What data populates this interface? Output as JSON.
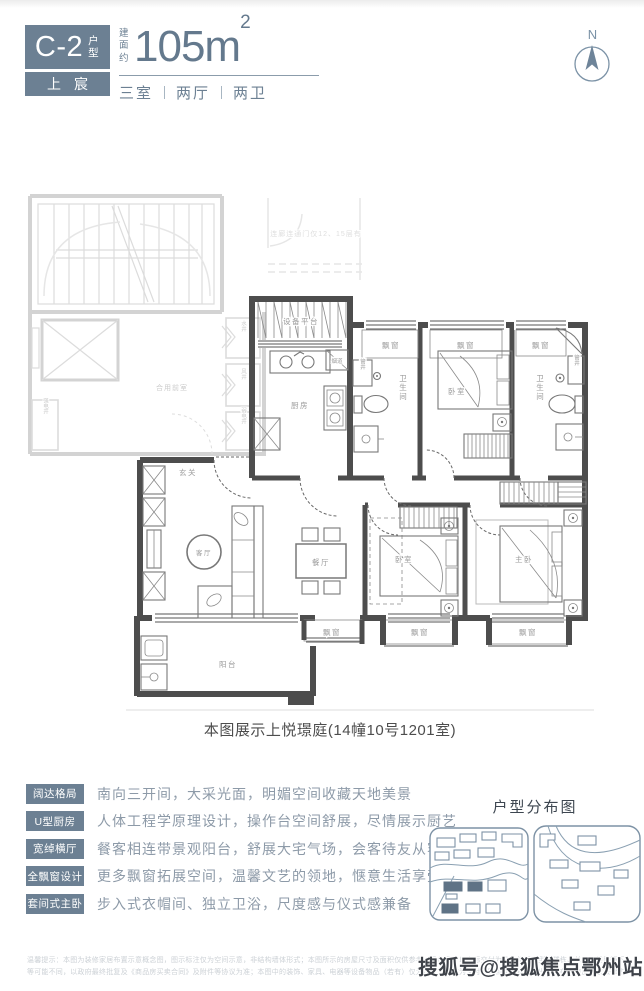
{
  "header": {
    "unit_code": "C-2",
    "unit_type": "户型",
    "brand": "上宸",
    "area_prefix": "建面约",
    "area_value": "105m",
    "area_sup": "2",
    "layout": [
      "三室",
      "两厅",
      "两卫"
    ],
    "north": "N"
  },
  "plan": {
    "common": {
      "bridge_note": "连廊连通门仅12、15层有",
      "shared_lobby": "合用前室",
      "water_shaft": "水井",
      "air_shaft": "风井",
      "weak_elec_shaft": "弱电井",
      "strong_elec_shaft": "强电井"
    },
    "rooms": {
      "equipment_platform": "设备平台",
      "kitchen": "厨房",
      "flue": "烟道",
      "pipe_shaft": "管井",
      "bathroom": "卫生间",
      "bay_window": "飘窗",
      "bedroom": "卧室",
      "master_bedroom": "主卧",
      "entry": "玄关",
      "living_room": "客厅",
      "dining_room": "餐厅",
      "balcony": "阳台"
    }
  },
  "caption": "本图展示上悦璟庭(14幢10号1201室)",
  "features": [
    {
      "tag": "阔达格局",
      "desc": "南向三开间，大采光面，明媚空间收藏天地美景"
    },
    {
      "tag": "U型厨房",
      "desc": "人体工程学原理设计，操作台空间舒展，尽情展示厨艺"
    },
    {
      "tag": "宽绰横厅",
      "desc": "餐客相连带景观阳台，舒展大宅气场，会客待友从容不迫"
    },
    {
      "tag": "全飘窗设计",
      "desc": "更多飘窗拓展空间，温馨文艺的领地，惬意生活享受"
    },
    {
      "tag": "套间式主卧",
      "desc": "步入式衣帽间、独立卫浴，尺度感与仪式感兼备"
    }
  ],
  "distribution": {
    "title": "户型分布图"
  },
  "disclaimer": {
    "line1": "温馨提示：本图为装修家居布置示意概念图，图示标注仅为空间示意，非结构墙体形式；本图所示的房屋尺寸及面积仅供参考，具体尺寸以实际交付为准。相同户型因楼栋、单元、楼层等不同，平面布局、阳台、飘窗、管井、烟道位置、外立面、设备平台",
    "line2": "等可能不同，以政府最终批复及《商品房买卖合同》及附件等协议为准；本图中的装饰、家具、电器等设备物品（若有）仅为示意，不作为交付内容和交付标准。出卖人在不违反国家法律法规的前提下保留调整权利。"
  },
  "watermark": "搜狐号@搜狐焦点鄂州站",
  "colors": {
    "accent": "#6c8093",
    "wall": "#4d4d4d",
    "common_wall": "#d3d3d3",
    "label": "#9b9b9b"
  }
}
